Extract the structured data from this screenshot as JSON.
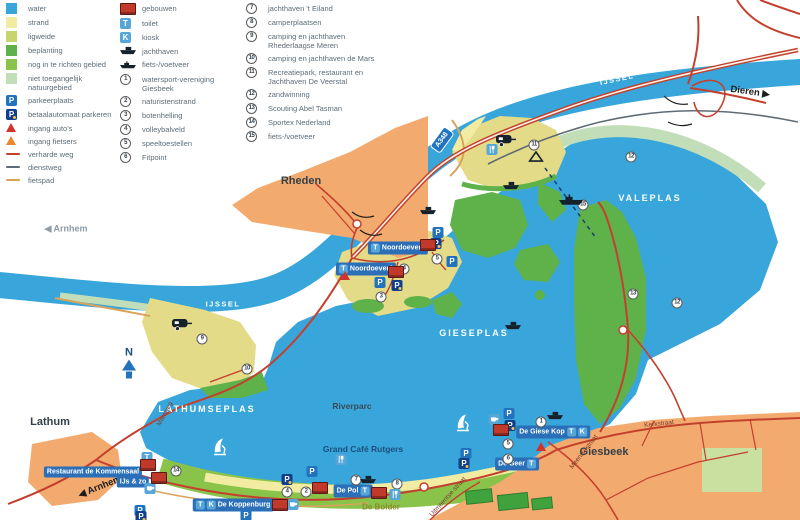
{
  "colors": {
    "water": "#38A6DA",
    "strand": "#F2ECA3",
    "ligweide": "#C8D46E",
    "beplanting": "#5FB24A",
    "nog": "#8AC34A",
    "natuur": "#C2DEB9",
    "campsand": "#E3DB88",
    "urban": "#F3AA6E",
    "road": "#C4402E",
    "dienstweg": "#5F6B74",
    "fietspad": "#D9A35B",
    "building": "#C0392B",
    "chipblue": "#2173BE",
    "chiplight": "#56A7D8",
    "chipdark": "#123F8C",
    "labelbg": "#2A6FB8",
    "entrcar": "#D0342C",
    "entrbike": "#E88A2E",
    "ferryline": "#1B3F6E",
    "sportfield": "#3FA23C"
  },
  "legend": {
    "columns": [
      {
        "x": 6,
        "w": 108,
        "items": [
          {
            "icon": "sw-water",
            "label": "water"
          },
          {
            "icon": "sw-strand",
            "label": "strand"
          },
          {
            "icon": "sw-ligweide",
            "label": "ligweide"
          },
          {
            "icon": "sw-beplanting",
            "label": "beplanting"
          },
          {
            "icon": "sw-nog",
            "label": "nog in te richten gebied"
          },
          {
            "icon": "sw-natuur",
            "label": "niet toegangelijk natuurgebied"
          },
          {
            "icon": "p",
            "label": "parkeerplaats"
          },
          {
            "icon": "pa",
            "label": "betaalautomaat parkeren"
          },
          {
            "icon": "tri-red",
            "label": "ingang auto's"
          },
          {
            "icon": "tri-orange",
            "label": "ingang fietsers"
          },
          {
            "icon": "line-road",
            "label": "verharde weg"
          },
          {
            "icon": "line-dienst",
            "label": "dienstweg"
          },
          {
            "icon": "line-fiets",
            "label": "fietspad"
          }
        ]
      },
      {
        "x": 120,
        "w": 122,
        "items": [
          {
            "icon": "bld",
            "label": "gebouwen"
          },
          {
            "icon": "t",
            "label": "toilet"
          },
          {
            "icon": "k",
            "label": "kiosk"
          },
          {
            "icon": "boat",
            "label": "jachthaven"
          },
          {
            "icon": "ferry",
            "label": "fiets-/voetveer"
          },
          {
            "icon": "n1",
            "label": "watersport-vereniging Giesbeek"
          },
          {
            "icon": "n2",
            "label": "naturistenstrand"
          },
          {
            "icon": "n3",
            "label": "botenhelling"
          },
          {
            "icon": "n4",
            "label": "volleybalveld"
          },
          {
            "icon": "n5",
            "label": "speeltoestellen"
          },
          {
            "icon": "n6",
            "label": "Fitpoint"
          }
        ]
      },
      {
        "x": 246,
        "w": 136,
        "items": [
          {
            "icon": "n7",
            "label": "jachthaven 't Eiland"
          },
          {
            "icon": "n8",
            "label": "camperplaatsen"
          },
          {
            "icon": "n9",
            "label": "camping en jachthaven Rhederlaagse Meren"
          },
          {
            "icon": "n10",
            "label": "camping en jachthaven de Mars"
          },
          {
            "icon": "n11",
            "label": "Recreatiepark, restaurant en Jachthaven De Veerstal"
          },
          {
            "icon": "n12",
            "label": "zandwinning"
          },
          {
            "icon": "n13",
            "label": "Scouting Abel Tasman"
          },
          {
            "icon": "n14",
            "label": "Sportex Nederland"
          },
          {
            "icon": "n15",
            "label": "fiets-/voetveer"
          }
        ]
      }
    ]
  },
  "map": {
    "compass": {
      "letter": "N",
      "x": 129,
      "y": 363
    },
    "shield": {
      "text": "A348",
      "x": 442,
      "y": 140,
      "rot": -54
    },
    "labels": [
      {
        "t": "IJSSEL",
        "x": 617,
        "y": 79,
        "c": "wsm",
        "r": -12
      },
      {
        "t": "IJSSEL",
        "x": 223,
        "y": 304,
        "c": "wsm",
        "r": 0
      },
      {
        "t": "VALEPLAS",
        "x": 650,
        "y": 198,
        "c": "wbig",
        "r": 0
      },
      {
        "t": "GIESEPLAS",
        "x": 474,
        "y": 333,
        "c": "wbig",
        "r": 0
      },
      {
        "t": "LATHUMSEPLAS",
        "x": 207,
        "y": 409,
        "c": "wbig",
        "r": 0
      },
      {
        "t": "Riverparc",
        "x": 352,
        "y": 406,
        "c": "poidark",
        "r": 0
      },
      {
        "t": "Rheden",
        "x": 301,
        "y": 181,
        "c": "town",
        "r": 0
      },
      {
        "t": "Lathum",
        "x": 50,
        "y": 422,
        "c": "town",
        "r": 0
      },
      {
        "t": "Giesbeek",
        "x": 604,
        "y": 452,
        "c": "town",
        "r": 0
      },
      {
        "t": "Dieren",
        "x": 750,
        "y": 92,
        "c": "dir",
        "r": 8,
        "a": "right"
      },
      {
        "t": "Arnhem",
        "x": 66,
        "y": 229,
        "c": "dirgray",
        "r": 0,
        "a": "left"
      },
      {
        "t": "Arnhem",
        "x": 100,
        "y": 487,
        "c": "dir",
        "r": -22,
        "a": "left"
      },
      {
        "t": "Grand Café Rutgers",
        "x": 363,
        "y": 449,
        "c": "poinavy",
        "r": 0
      },
      {
        "t": "De Bolder",
        "x": 381,
        "y": 507,
        "c": "poiolive",
        "r": 0
      },
      {
        "t": "Marsweg",
        "x": 165,
        "y": 414,
        "c": "street",
        "r": -62
      },
      {
        "t": "Meentsestraat",
        "x": 584,
        "y": 452,
        "c": "street",
        "r": -52
      },
      {
        "t": "Kerkstraat",
        "x": 659,
        "y": 424,
        "c": "street",
        "r": -6
      },
      {
        "t": "Uitmeentse straat",
        "x": 448,
        "y": 497,
        "c": "street",
        "r": -48
      }
    ],
    "pills": [
      {
        "t": "Noordoever2",
        "pre": [
          "t"
        ],
        "post": [],
        "x": 398,
        "y": 248
      },
      {
        "t": "Noordoever1",
        "pre": [
          "t"
        ],
        "post": [],
        "x": 366,
        "y": 269
      },
      {
        "t": "De Giese Kop",
        "pre": [],
        "post": [
          "t",
          "k"
        ],
        "x": 553,
        "y": 432
      },
      {
        "t": "De Geer",
        "pre": [],
        "post": [
          "t"
        ],
        "x": 517,
        "y": 464
      },
      {
        "t": "De Pol",
        "pre": [],
        "post": [
          "t"
        ],
        "x": 353,
        "y": 491
      },
      {
        "t": "De Koppenburg",
        "pre": [
          "t",
          "k"
        ],
        "post": [],
        "x": 233,
        "y": 505
      },
      {
        "t": "Restaurant de Kommensaal",
        "pre": [],
        "post": [],
        "x": 93,
        "y": 472
      },
      {
        "t": "IJs & zo",
        "pre": [],
        "post": [],
        "x": 133,
        "y": 482
      }
    ],
    "markers": [
      {
        "n": "1",
        "x": 541,
        "y": 422
      },
      {
        "n": "2",
        "x": 306,
        "y": 492
      },
      {
        "n": "3",
        "x": 381,
        "y": 297
      },
      {
        "n": "4",
        "x": 404,
        "y": 269
      },
      {
        "n": "4",
        "x": 287,
        "y": 492
      },
      {
        "n": "5",
        "x": 437,
        "y": 259
      },
      {
        "n": "5",
        "x": 508,
        "y": 444
      },
      {
        "n": "6",
        "x": 508,
        "y": 459
      },
      {
        "n": "7",
        "x": 356,
        "y": 480
      },
      {
        "n": "8",
        "x": 397,
        "y": 484
      },
      {
        "n": "9",
        "x": 202,
        "y": 339
      },
      {
        "n": "10",
        "x": 247,
        "y": 369
      },
      {
        "n": "11",
        "x": 534,
        "y": 145
      },
      {
        "n": "12",
        "x": 631,
        "y": 157
      },
      {
        "n": "12",
        "x": 677,
        "y": 303
      },
      {
        "n": "13",
        "x": 633,
        "y": 294
      },
      {
        "n": "14",
        "x": 176,
        "y": 471
      },
      {
        "n": "15",
        "x": 583,
        "y": 205
      }
    ],
    "icons": [
      {
        "k": "p",
        "x": 438,
        "y": 231
      },
      {
        "k": "p",
        "x": 452,
        "y": 260
      },
      {
        "k": "p",
        "x": 380,
        "y": 281
      },
      {
        "k": "p",
        "x": 509,
        "y": 412
      },
      {
        "k": "p",
        "x": 466,
        "y": 452
      },
      {
        "k": "p",
        "x": 312,
        "y": 470
      },
      {
        "k": "p",
        "x": 246,
        "y": 514
      },
      {
        "k": "p",
        "x": 140,
        "y": 509
      },
      {
        "k": "pa",
        "x": 436,
        "y": 242
      },
      {
        "k": "pa",
        "x": 397,
        "y": 284
      },
      {
        "k": "pa",
        "x": 510,
        "y": 424
      },
      {
        "k": "pa",
        "x": 464,
        "y": 462
      },
      {
        "k": "pa",
        "x": 287,
        "y": 478
      },
      {
        "k": "pa",
        "x": 141,
        "y": 515
      },
      {
        "k": "t",
        "x": 147,
        "y": 456
      },
      {
        "k": "cup",
        "x": 494,
        "y": 420
      },
      {
        "k": "cup",
        "x": 293,
        "y": 505
      },
      {
        "k": "cup",
        "x": 150,
        "y": 489
      },
      {
        "k": "fork",
        "x": 492,
        "y": 150
      },
      {
        "k": "fork",
        "x": 341,
        "y": 460
      },
      {
        "k": "fork",
        "x": 395,
        "y": 495
      },
      {
        "k": "bld",
        "x": 428,
        "y": 247
      },
      {
        "k": "bld",
        "x": 396,
        "y": 274
      },
      {
        "k": "bld",
        "x": 148,
        "y": 467
      },
      {
        "k": "bld",
        "x": 159,
        "y": 480
      },
      {
        "k": "bld",
        "x": 320,
        "y": 490
      },
      {
        "k": "bld",
        "x": 379,
        "y": 495
      },
      {
        "k": "bld",
        "x": 501,
        "y": 432
      },
      {
        "k": "bld",
        "x": 280,
        "y": 507
      },
      {
        "k": "boat",
        "x": 368,
        "y": 480
      },
      {
        "k": "boat",
        "x": 555,
        "y": 416
      },
      {
        "k": "boat",
        "x": 511,
        "y": 186
      },
      {
        "k": "boat",
        "x": 428,
        "y": 211
      },
      {
        "k": "boat",
        "x": 513,
        "y": 326
      },
      {
        "k": "ferry",
        "x": 571,
        "y": 202
      },
      {
        "k": "caravan",
        "x": 182,
        "y": 327
      },
      {
        "k": "caravan",
        "x": 506,
        "y": 143
      },
      {
        "k": "tent",
        "x": 536,
        "y": 158
      },
      {
        "k": "windsurf",
        "x": 463,
        "y": 425
      },
      {
        "k": "windsurf",
        "x": 220,
        "y": 449
      },
      {
        "k": "tri-red",
        "x": 345,
        "y": 276
      },
      {
        "k": "tri-red",
        "x": 541,
        "y": 447
      }
    ]
  }
}
